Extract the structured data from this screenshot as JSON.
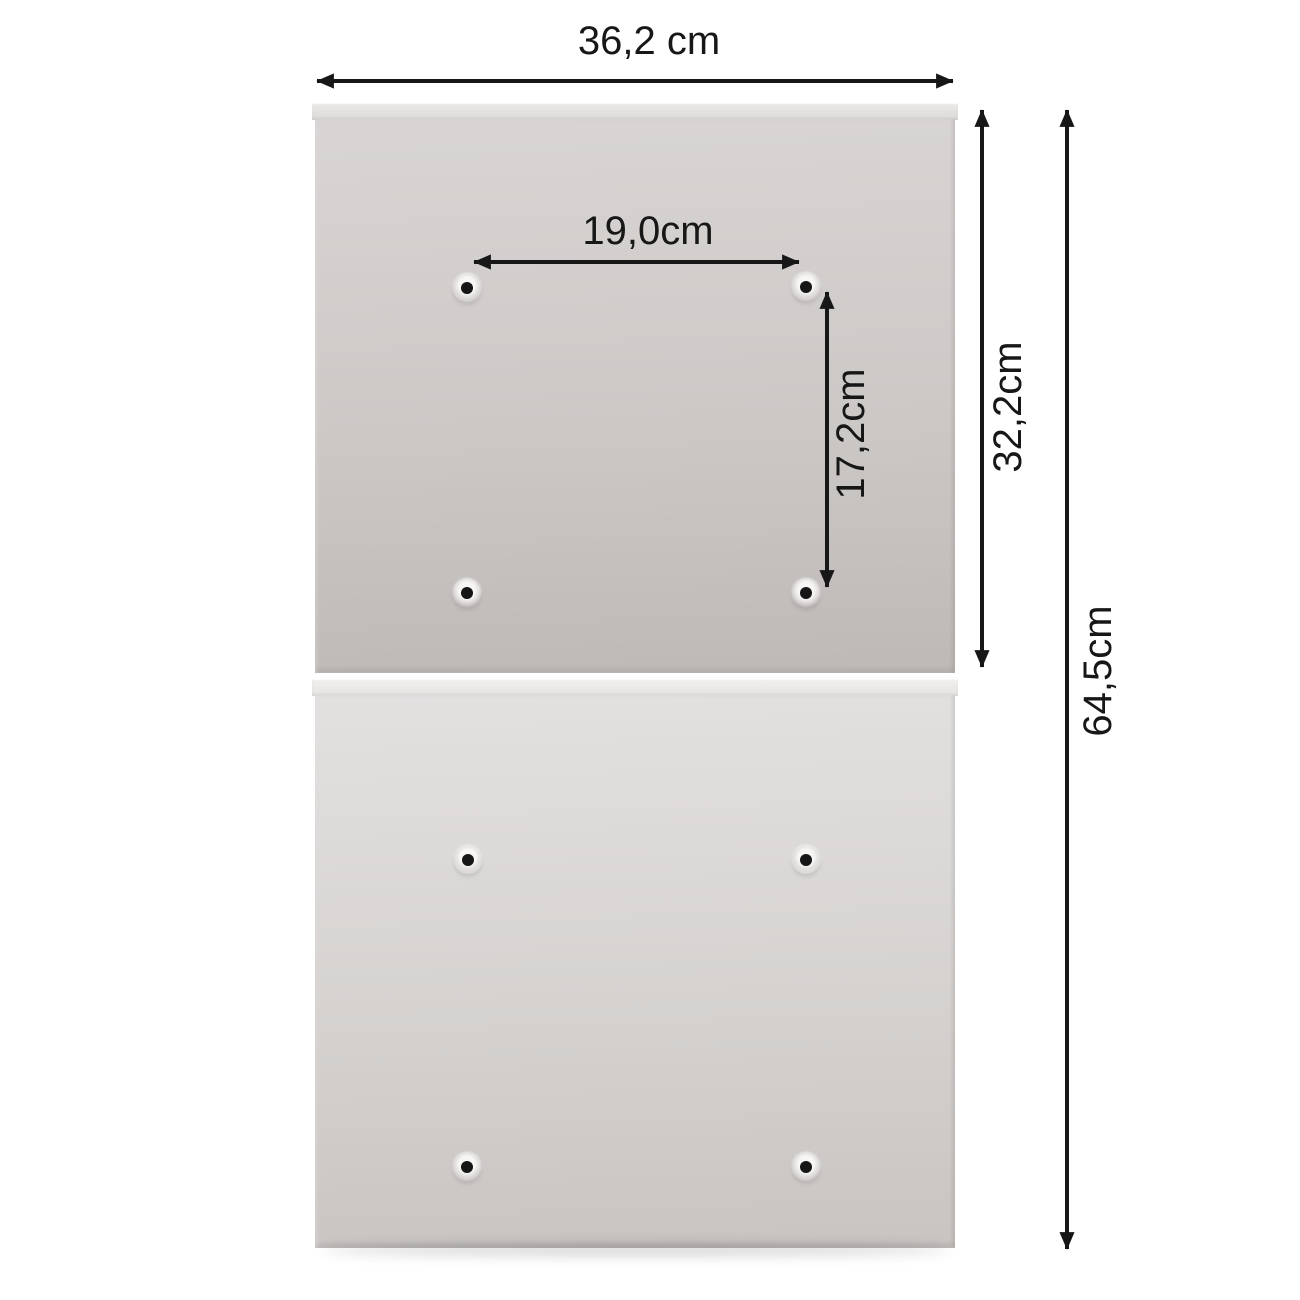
{
  "colors": {
    "bg": "#ffffff",
    "ink": "#171717",
    "panel-top-a": "#d8d5d4",
    "panel-top-b": "#ccc8c6",
    "panel-top-c": "#beb9b7",
    "panel-bot-a": "#e3e1e0",
    "panel-bot-b": "#d5d2d0",
    "panel-bot-c": "#c8c4c2",
    "lip-top-a": "#ebe9e8",
    "lip-top-b": "#dcdad9",
    "lip-bot-a": "#f1f0ef",
    "lip-bot-b": "#e5e3e2",
    "hole-dot": "#161616"
  },
  "diagram": {
    "dimensions": {
      "overall_width": "36,2 cm",
      "hole_spacing_horizontal": "19,0cm",
      "hole_spacing_vertical": "17,2cm",
      "upper_panel_height": "32,2cm",
      "overall_height": "64,5cm"
    }
  }
}
